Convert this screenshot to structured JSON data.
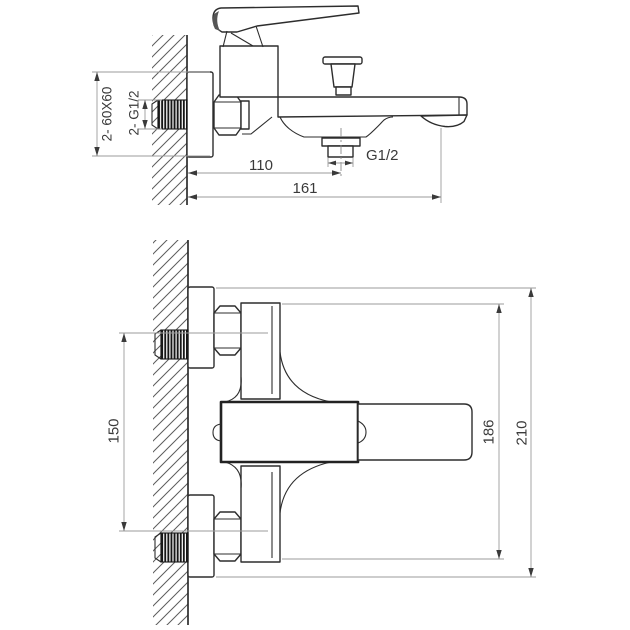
{
  "drawing": {
    "subject": "Wall-mounted single-lever bath mixer - dimensional drawing, side and front views",
    "side_view": {
      "labels": {
        "wall_plates": "2- 60X60",
        "inlet_connections": "2- G1/2",
        "wall_to_shower_outlet_mm": "110",
        "wall_to_spout_mm": "161",
        "shower_outlet_thread": "G1/2"
      }
    },
    "front_view": {
      "labels": {
        "inlet_spacing_mm": "150",
        "body_height_mm": "186",
        "overall_height_mm": "210"
      }
    },
    "colors": {
      "background": "#ffffff",
      "outline": "#2d2d2d",
      "dimension_line": "#9b9b9b",
      "text": "#3a3a3a"
    }
  }
}
